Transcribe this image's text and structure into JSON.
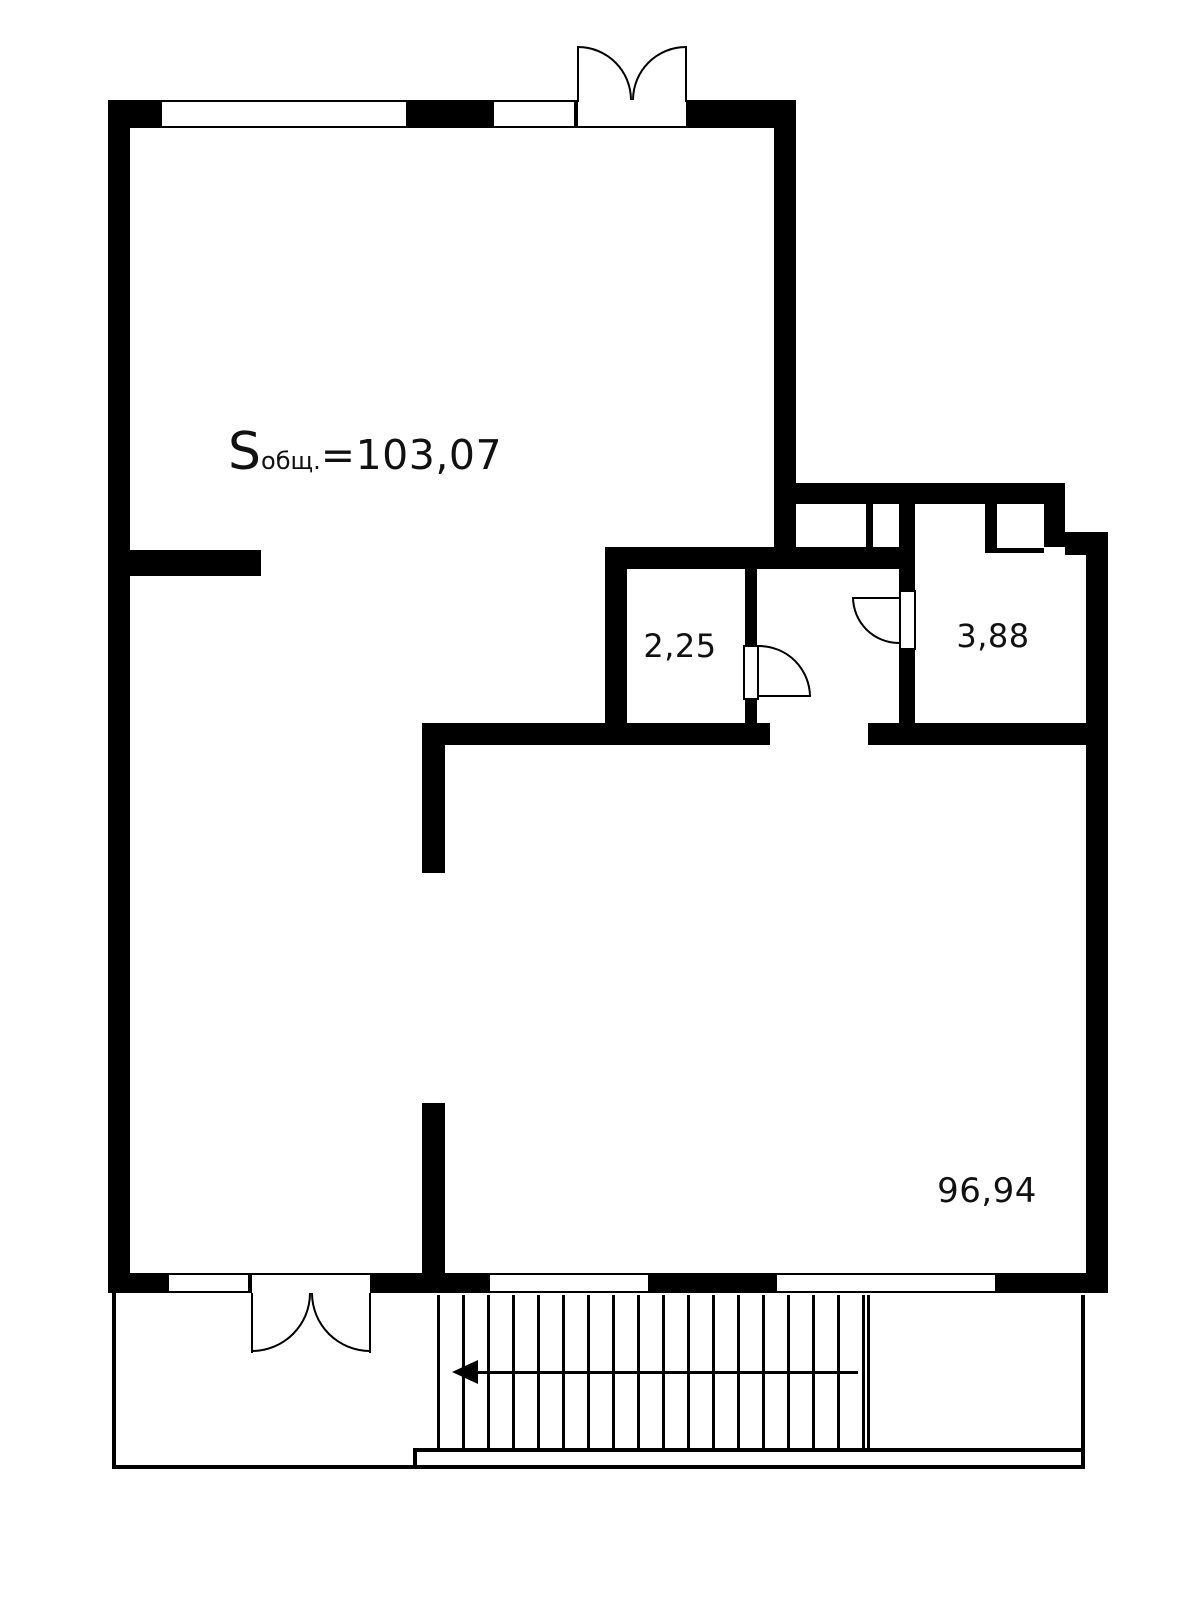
{
  "floor_plan": {
    "background_color": "#ffffff",
    "wall_color": "#000000",
    "total_area": {
      "prefix": "S",
      "subscript": "общ.",
      "equals_value": "=103,07"
    },
    "rooms": [
      {
        "id": "upper-unit",
        "area": "103,07"
      },
      {
        "id": "small-room-left",
        "area": "2,25"
      },
      {
        "id": "small-room-right",
        "area": "3,88"
      },
      {
        "id": "lower-unit",
        "area": "96,94"
      }
    ],
    "features": [
      "double-door-top",
      "double-door-bottom",
      "interior-door-left",
      "interior-door-right",
      "stairs-with-arrow",
      "terrace"
    ]
  }
}
